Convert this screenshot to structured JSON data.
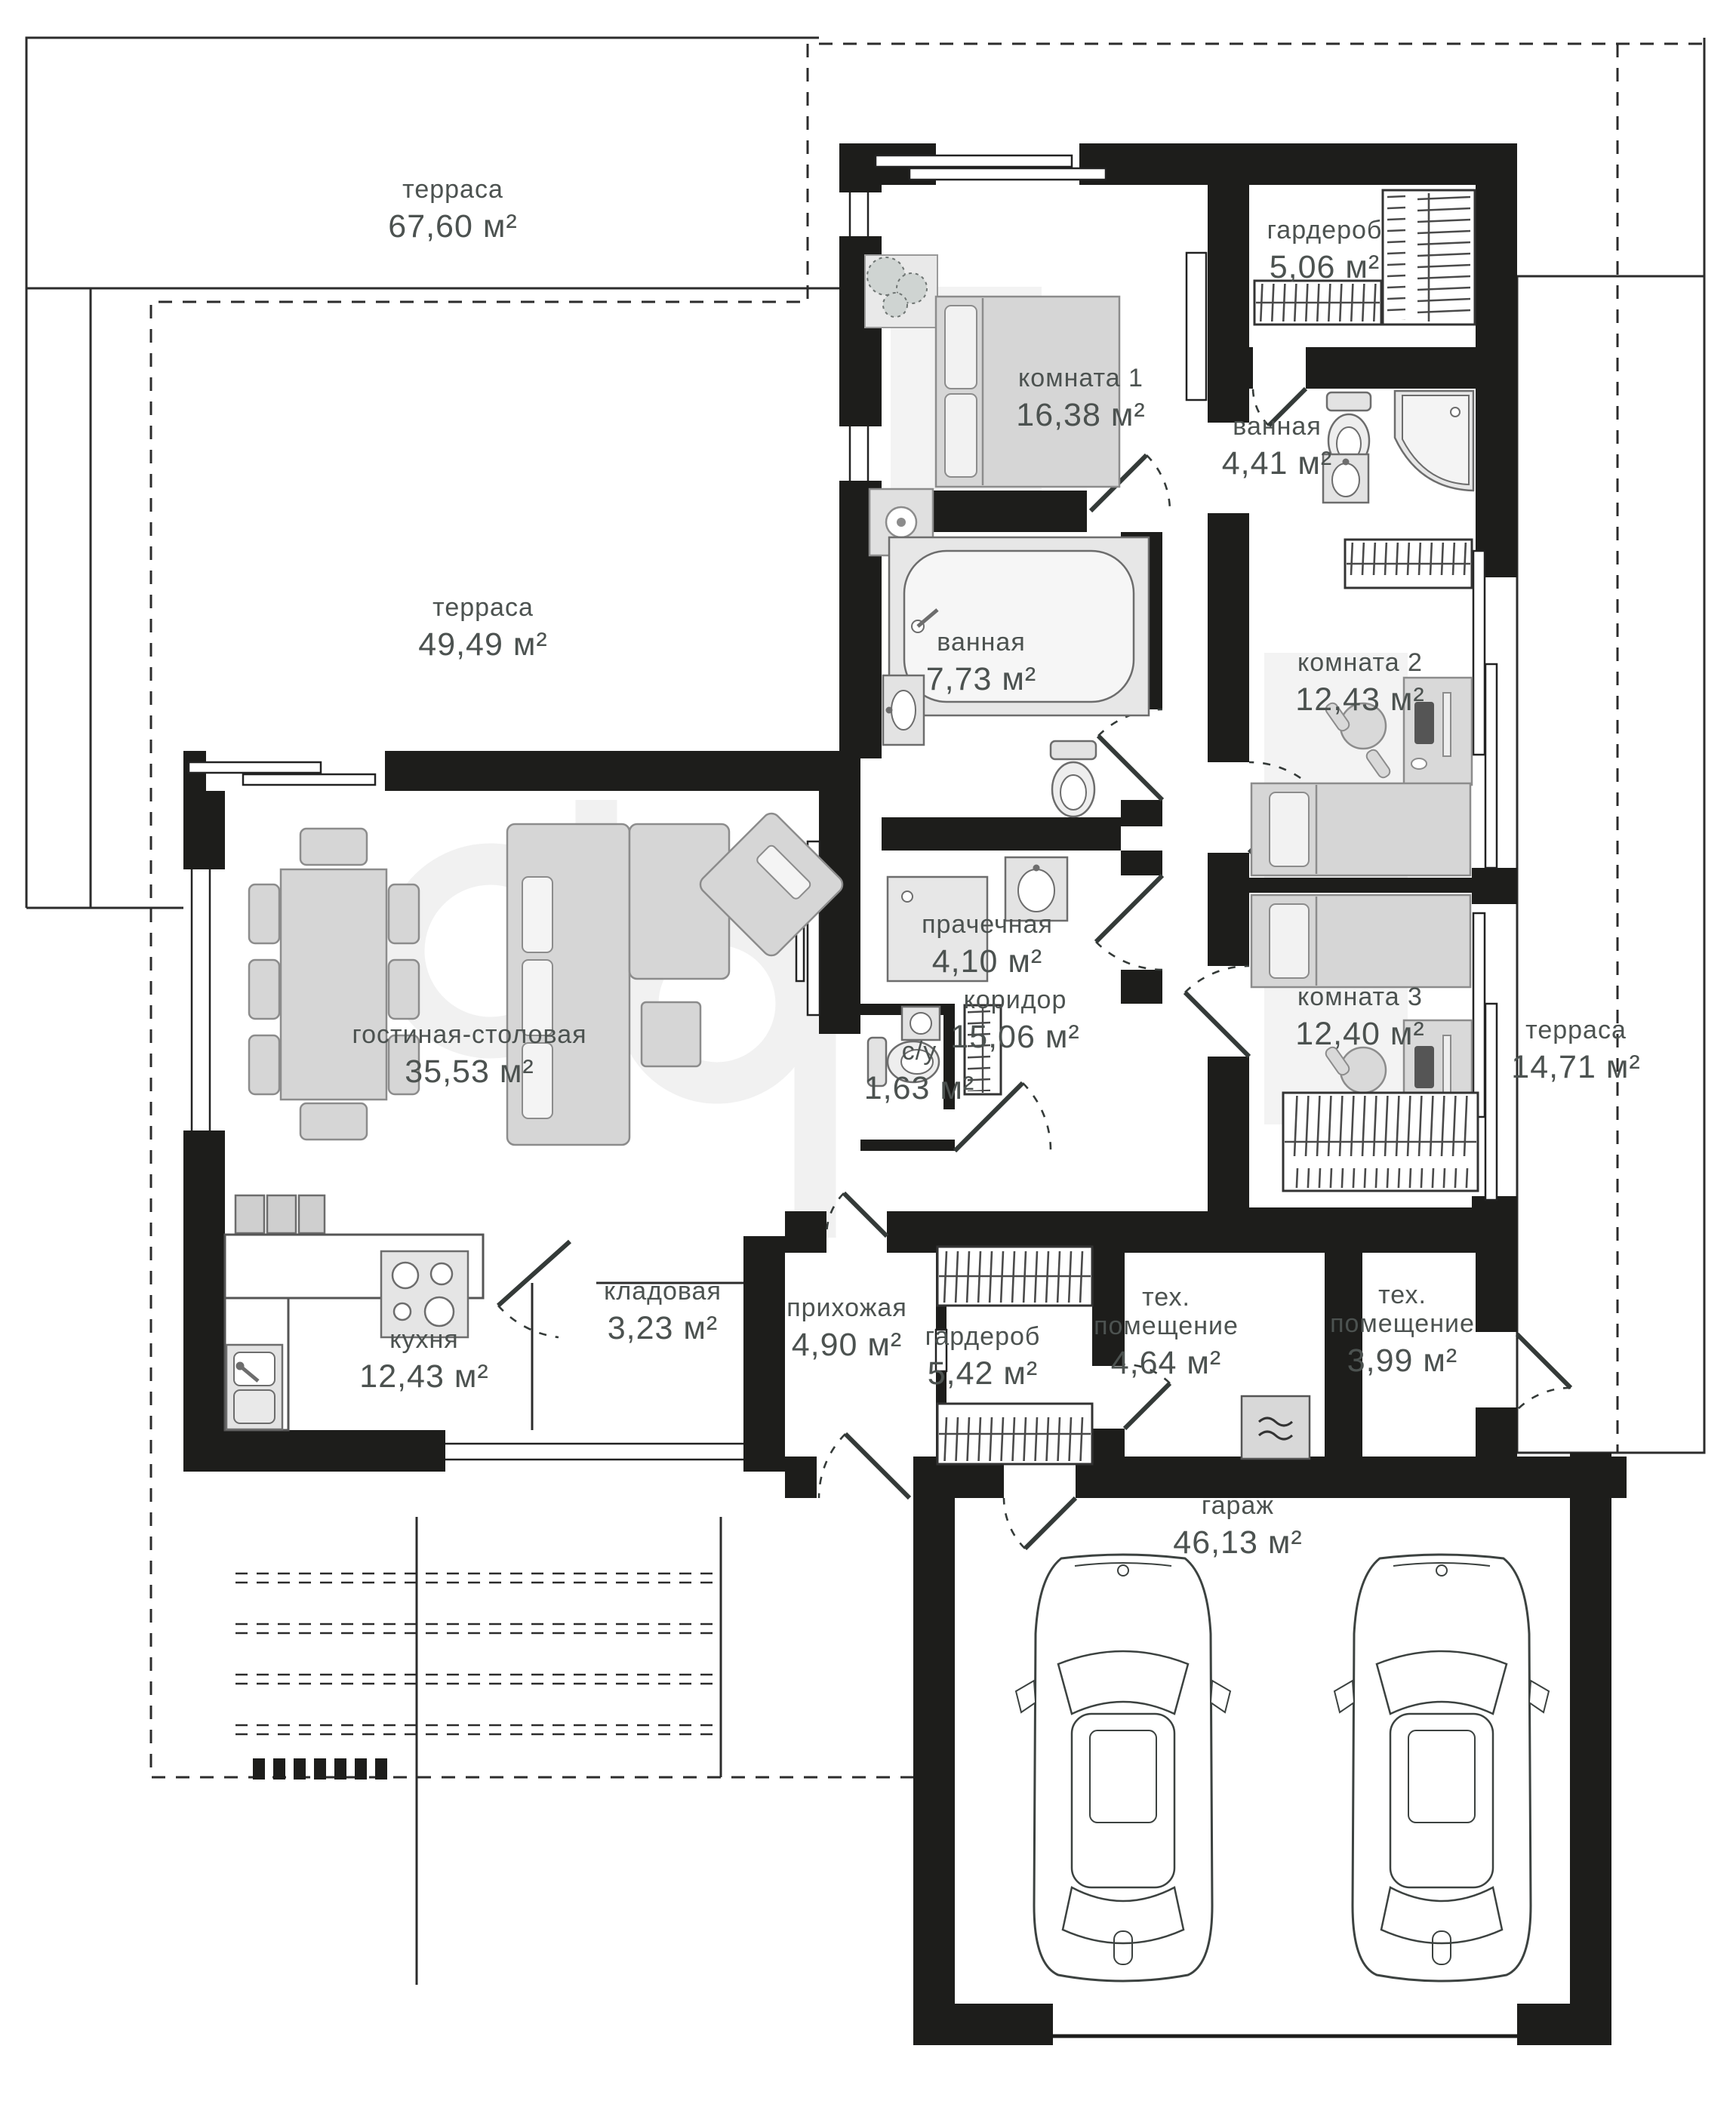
{
  "plan_title": "floor-plan",
  "units": "м²",
  "rooms": [
    {
      "name": "терраса",
      "area": "67,60 м²"
    },
    {
      "name": "терраса",
      "area": "49,49 м²"
    },
    {
      "name": "гардероб",
      "area": "5,06 м²"
    },
    {
      "name": "комната 1",
      "area": "16,38 м²"
    },
    {
      "name": "ванная",
      "area": "4,41 м²"
    },
    {
      "name": "ванная",
      "area": "7,73 м²"
    },
    {
      "name": "комната 2",
      "area": "12,43 м²"
    },
    {
      "name": "прачечная",
      "area": "4,10 м²"
    },
    {
      "name": "коридор",
      "area": "15,06 м²"
    },
    {
      "name": "с/у",
      "area": "1,63 м²"
    },
    {
      "name": "комната 3",
      "area": "12,40 м²"
    },
    {
      "name": "терраса",
      "area": "14,71 м²"
    },
    {
      "name": "гостиная-столовая",
      "area": "35,53 м²"
    },
    {
      "name": "кухня",
      "area": "12,43 м²"
    },
    {
      "name": "кладовая",
      "area": "3,23 м²"
    },
    {
      "name": "прихожая",
      "area": "4,90 м²"
    },
    {
      "name": "гардероб",
      "area": "5,42 м²"
    },
    {
      "name": "тех. помещение",
      "area": "4,64 м²"
    },
    {
      "name": "тех. помещение",
      "area": "3,99 м²"
    },
    {
      "name": "гараж",
      "area": "46,13 м²"
    }
  ]
}
